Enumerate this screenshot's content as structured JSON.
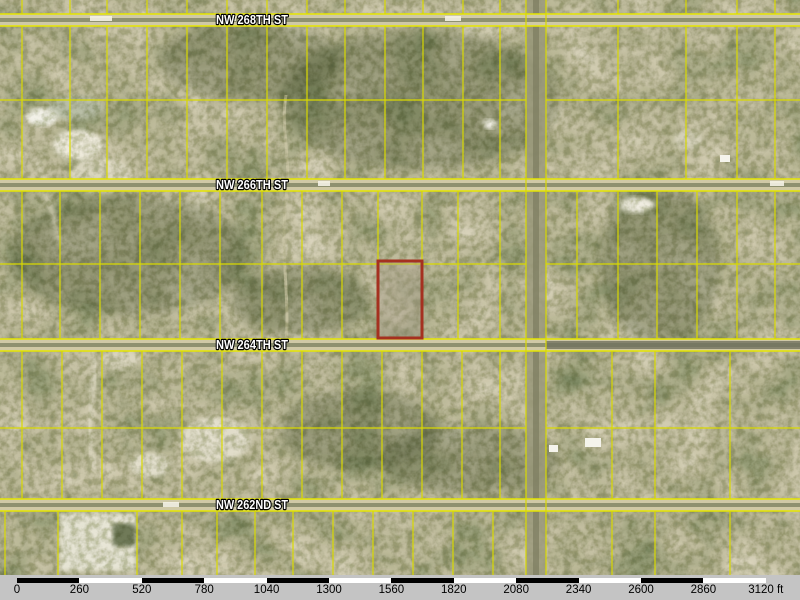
{
  "map": {
    "title": "parcel-aerial-map",
    "height": 575,
    "streets": [
      {
        "label": "NW 268TH ST",
        "y": 20
      },
      {
        "label": "NW 266TH ST",
        "y": 185
      },
      {
        "label": "NW 264TH ST",
        "y": 345
      },
      {
        "label": "NW 262ND ST",
        "y": 505
      }
    ],
    "street_label_center_x": 252,
    "vertical_road_x": [
      526,
      546
    ],
    "highlight_parcel": {
      "x": 378,
      "y": 261,
      "width": 44,
      "height": 77
    },
    "grid_rows": [
      {
        "top": 0,
        "bottom": 14,
        "mid": null,
        "cols_left": [
          22,
          70,
          107,
          147,
          187,
          227,
          267,
          307,
          345,
          385,
          423,
          463,
          500
        ],
        "cols_right": [
          618,
          686,
          737,
          775
        ]
      },
      {
        "top": 26,
        "bottom": 179,
        "mid": 100,
        "cols_left": [
          22,
          70,
          107,
          147,
          187,
          227,
          267,
          307,
          345,
          385,
          423,
          463,
          500
        ],
        "cols_right": [
          618,
          686,
          737,
          775
        ]
      },
      {
        "top": 191,
        "bottom": 339,
        "mid": 264,
        "cols_left": [
          22,
          60,
          100,
          140,
          180,
          220,
          262,
          302,
          342,
          378,
          422,
          458,
          500
        ],
        "cols_right": [
          577,
          618,
          657,
          697,
          737,
          775
        ]
      },
      {
        "top": 351,
        "bottom": 499,
        "mid": 428,
        "cols_left": [
          22,
          62,
          102,
          142,
          182,
          222,
          262,
          302,
          342,
          382,
          422,
          462,
          500
        ],
        "cols_right": [
          612,
          655,
          730
        ]
      },
      {
        "top": 511,
        "bottom": 575,
        "mid": null,
        "cols_left": [
          5,
          58,
          137,
          182,
          217,
          255,
          293,
          333,
          373,
          413,
          453,
          493
        ],
        "cols_right": [
          612,
          655,
          730
        ]
      }
    ],
    "colors": {
      "map_base": "#96956e",
      "parcel_line": "#d9d900",
      "street_edge": "#e6e600",
      "street_fill": "#cfc9a6",
      "street_center": "#8e9170",
      "street_dark_east": "#70725f",
      "road_fill": "#9b9a7c",
      "highlight": "#a53120",
      "scalebar_bg": "#c4c4c4"
    }
  },
  "scale_bar": {
    "unit": "ft",
    "origin_x": 17,
    "step_px": 62.4,
    "labels": [
      "0",
      "260",
      "520",
      "780",
      "1040",
      "1300",
      "1560",
      "1820",
      "2080",
      "2340",
      "2600",
      "2860",
      "3120 ft"
    ]
  }
}
